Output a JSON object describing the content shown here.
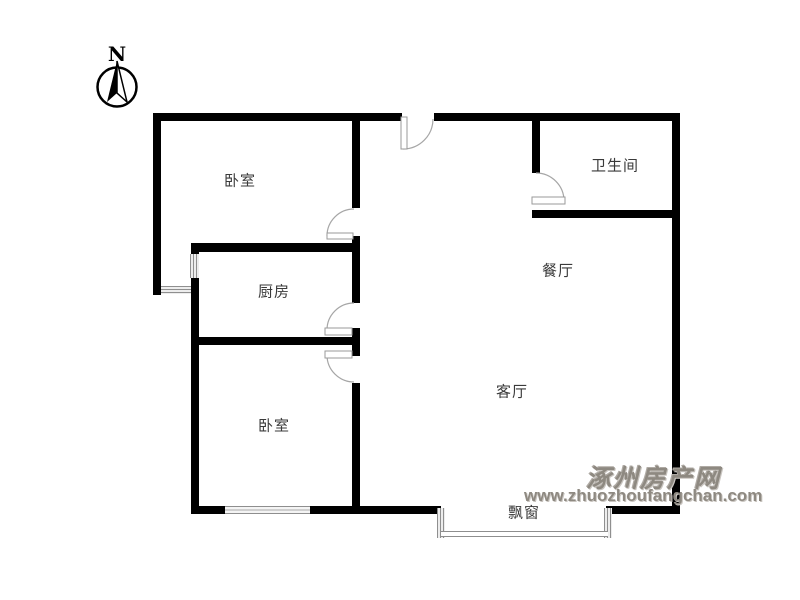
{
  "compass": {
    "label": "N"
  },
  "rooms": {
    "bedroom_top": "卧室",
    "bathroom": "卫生间",
    "kitchen": "厨房",
    "dining": "餐厅",
    "bedroom_bottom": "卧室",
    "living": "客厅",
    "bay_window": "飘窗"
  },
  "watermark": {
    "site_name": "涿州房产网",
    "site_url": "www.zhuozhoufangchan.com"
  },
  "colors": {
    "wall": "#000000",
    "door_line": "#a6a6a6",
    "watermark_gray": "#8e8981"
  }
}
